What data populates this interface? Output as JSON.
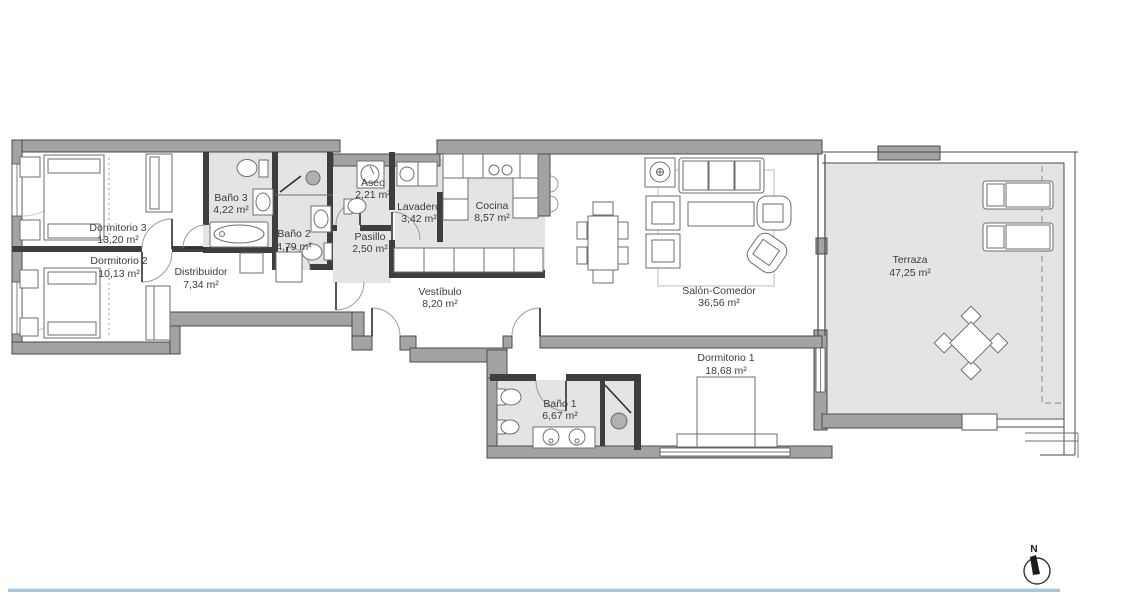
{
  "plan": {
    "rooms": [
      {
        "name": "Dormitorio 3",
        "area": "13,20 m²"
      },
      {
        "name": "Dormitorio 2",
        "area": "10,13 m²"
      },
      {
        "name": "Distribuidor",
        "area": "7,34 m²"
      },
      {
        "name": "Baño 3",
        "area": "4,22 m²"
      },
      {
        "name": "Baño 2",
        "area": "4,79 m²"
      },
      {
        "name": "Aseo",
        "area": "2,21 m²"
      },
      {
        "name": "Pasillo",
        "area": "2,50 m²"
      },
      {
        "name": "Lavadero",
        "area": "3,42 m²"
      },
      {
        "name": "Cocina",
        "area": "8,57 m²"
      },
      {
        "name": "Vestíbulo",
        "area": "8,20 m²"
      },
      {
        "name": "Salón-Comedor",
        "area": "36,56 m²"
      },
      {
        "name": "Dormitorio 1",
        "area": "18,68 m²"
      },
      {
        "name": "Baño 1",
        "area": "6,67 m²"
      },
      {
        "name": "Terraza",
        "area": "47,25 m²"
      }
    ],
    "compass": {
      "label": "N"
    },
    "colors": {
      "wall": "#a3a3a3",
      "partition": "#3e3e3e",
      "floor_tile": "#e4e4e4",
      "accent_line": "#a6c7dd"
    }
  }
}
